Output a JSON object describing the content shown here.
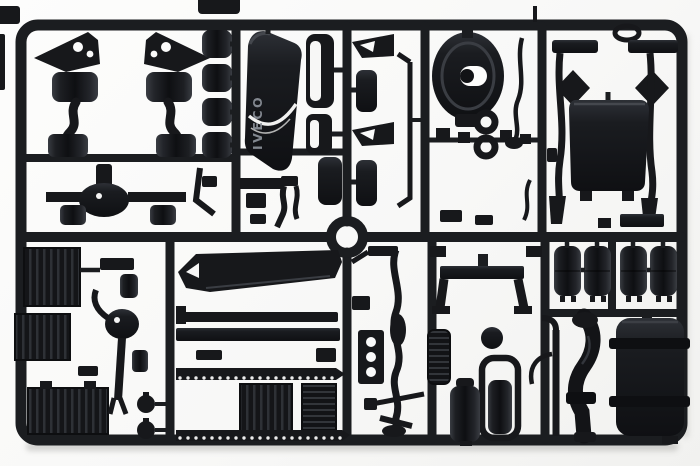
{
  "scene": {
    "type": "product-photograph",
    "subject": "black injection-molded plastic sprue (parts tree) of a truck scale-model kit",
    "background_color": "#f8f8f7",
    "plastic_color": "#17181b",
    "highlight_color": "#3a3d43",
    "molded_text": "IVECO",
    "frame": {
      "shape": "rounded-rectangle runner frame",
      "center_ring": "circular runner ring at sprue center",
      "halves": 2
    }
  },
  "parts": [
    {
      "name": "suspension-arm-left",
      "desc": "mirrored suspension bracket with air spring"
    },
    {
      "name": "suspension-arm-right",
      "desc": "mirrored suspension bracket with air spring"
    },
    {
      "name": "air-spring-cylinders",
      "desc": "column of four cylindrical air springs"
    },
    {
      "name": "front-axle-differential",
      "desc": "axle beam with central differential and brake drums"
    },
    {
      "name": "sun-visor",
      "desc": "cab sun visor with molded IVECO lettering"
    },
    {
      "name": "mirror-housings",
      "desc": "two rounded mirror shells"
    },
    {
      "name": "clamp-bracket",
      "desc": "wedge clamp bracket"
    },
    {
      "name": "mud-flaps",
      "desc": "two rounded mud flaps"
    },
    {
      "name": "linkage-rod",
      "desc": "long thin L-shaped rod"
    },
    {
      "name": "clutch-housing",
      "desc": "round bell housing with center opening"
    },
    {
      "name": "towing-rings",
      "desc": "two ring eyelets"
    },
    {
      "name": "shift-lever",
      "desc": "bent lever rod"
    },
    {
      "name": "fittings-row",
      "desc": "row of small square fittings"
    },
    {
      "name": "mirror-arm-left",
      "desc": "wing mirror arm with diamond head"
    },
    {
      "name": "mirror-arm-right",
      "desc": "wing mirror arm with diamond head"
    },
    {
      "name": "cab-rear-panel",
      "desc": "large rectangular cab panel"
    },
    {
      "name": "roof-bar",
      "desc": "short rectangular bar"
    },
    {
      "name": "ring-gasket",
      "desc": "small oval ring"
    },
    {
      "name": "radiator-box",
      "desc": "ribbed radiator block"
    },
    {
      "name": "battery-box",
      "desc": "ribbed battery block"
    },
    {
      "name": "intercooler-box",
      "desc": "large ribbed block"
    },
    {
      "name": "steering-knuckle",
      "desc": "knuckle ball with long shaft"
    },
    {
      "name": "front-spoiler",
      "desc": "long wedge spoiler"
    },
    {
      "name": "chassis-rails",
      "desc": "two straight rail bars"
    },
    {
      "name": "step-tread-upper",
      "desc": "perforated step tread"
    },
    {
      "name": "step-tread-lower",
      "desc": "perforated step tread"
    },
    {
      "name": "cab-floor-panel",
      "desc": "ribbed floor panel"
    },
    {
      "name": "radiator-core",
      "desc": "slotted grille core"
    },
    {
      "name": "stabilizer-bar",
      "desc": "long S-curved stabilizer"
    },
    {
      "name": "three-hole-bracket",
      "desc": "plate with three holes"
    },
    {
      "name": "small-muffler",
      "desc": "ribbed small silencer"
    },
    {
      "name": "fuel-cap-disc",
      "desc": "round cap disc"
    },
    {
      "name": "seal-frame",
      "desc": "rounded rectangular seal frame"
    },
    {
      "name": "cross-member",
      "desc": "U-shaped chassis cross member"
    },
    {
      "name": "exhaust-muffler-a",
      "desc": "vertical muffler cylinder"
    },
    {
      "name": "exhaust-muffler-b",
      "desc": "vertical muffler cylinder"
    },
    {
      "name": "exhaust-downpipe",
      "desc": "thick curved exhaust pipe"
    },
    {
      "name": "hook-rod",
      "desc": "small U hook rod"
    },
    {
      "name": "air-tanks",
      "desc": "four cylindrical air reservoirs"
    },
    {
      "name": "fuel-tank",
      "desc": "large cylindrical fuel tank with two straps"
    },
    {
      "name": "knob-pins",
      "desc": "two mushroom knob pins"
    },
    {
      "name": "edge-fragments",
      "desc": "cropped fragments of neighbouring sprue at image edges"
    }
  ]
}
